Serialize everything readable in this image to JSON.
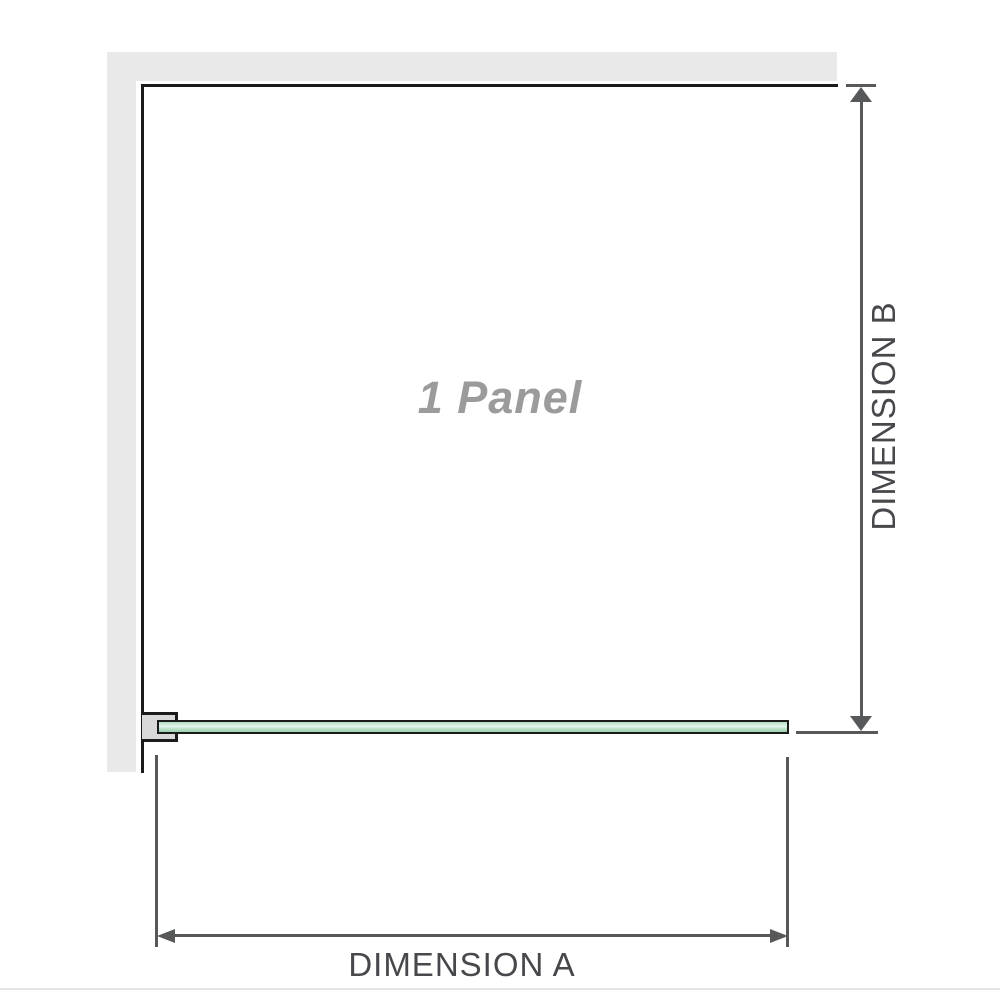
{
  "diagram": {
    "panel_label": "1 Panel",
    "dimension_a_label": "DIMENSION A",
    "dimension_b_label": "DIMENSION B"
  },
  "icons": {
    "dimension_b_top": "arrow-up-icon",
    "dimension_b_bottom": "arrow-down-icon",
    "dimension_a_left": "arrow-left-icon",
    "dimension_a_right": "arrow-right-icon"
  },
  "colors": {
    "wall": "#e9e9e9",
    "edge": "#1b1b1b",
    "dimension": "#56585a",
    "label_text": "#46484b",
    "panel_text": "#9b9b9b",
    "bracket_fill": "#d9d9d9",
    "glass_border": "#1b1b1b",
    "glass_top": "#b9e1c8",
    "glass_light": "#e9f5ee",
    "glass_bottom": "#9dd5b0",
    "baseline": "#e5e5e1"
  }
}
